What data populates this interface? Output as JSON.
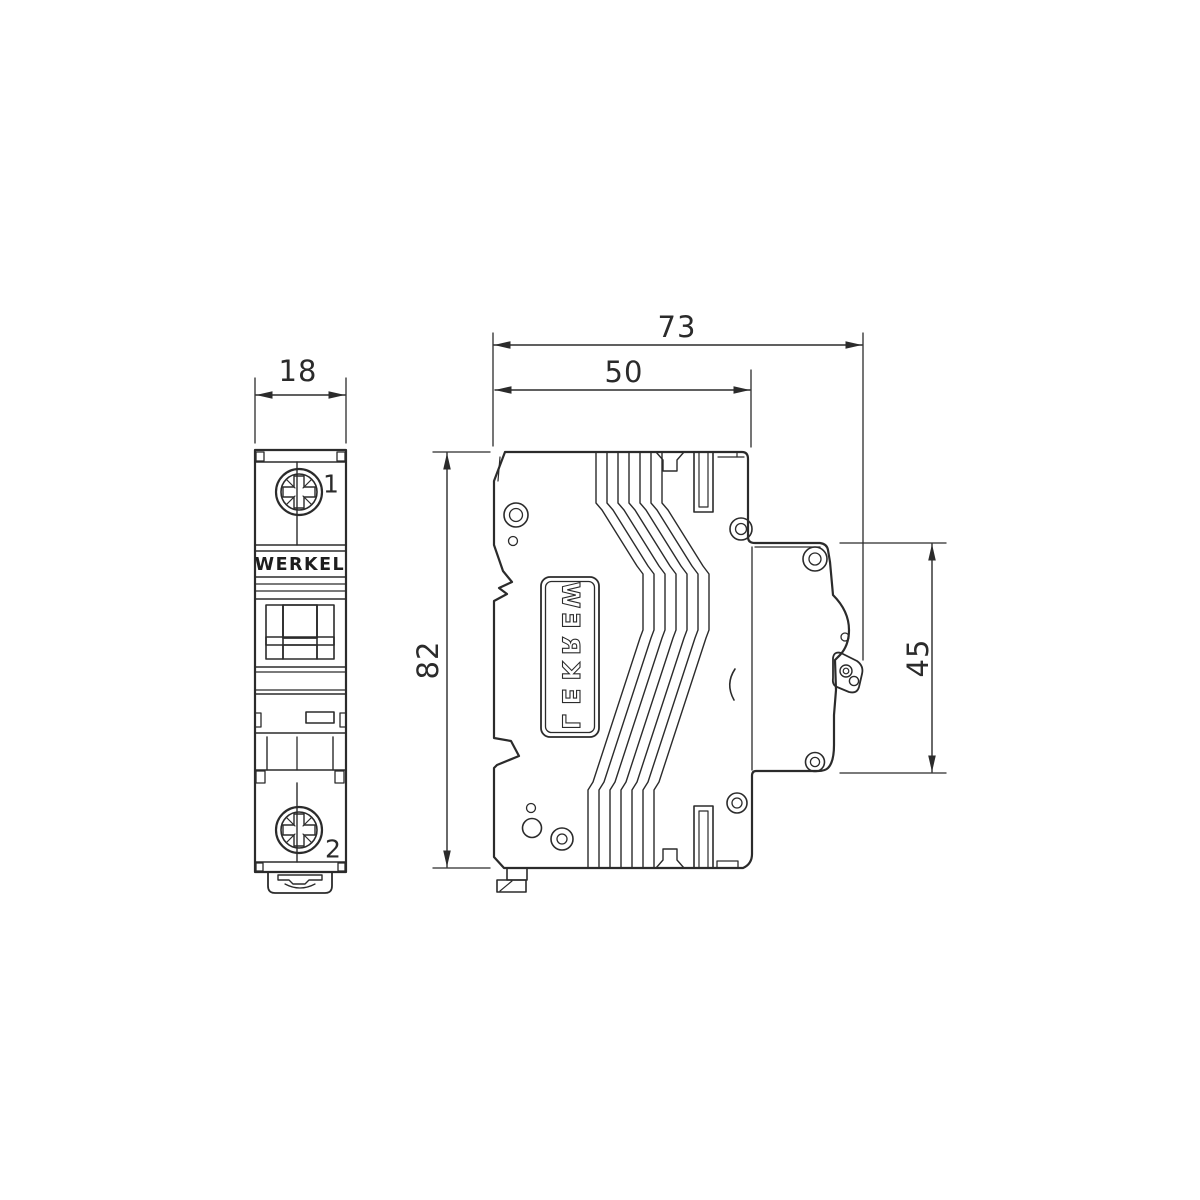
{
  "brand": "WERKEL",
  "front_view": {
    "terminal_top_label": "1",
    "terminal_bottom_label": "2",
    "brand_label": "WERKEL"
  },
  "side_view": {
    "brand_label": "WERKEL",
    "label_letters": [
      "W",
      "E",
      "R",
      "K",
      "E",
      "L"
    ]
  },
  "dimensions": {
    "front_width_mm": "18",
    "total_depth_mm": "73",
    "body_depth_mm": "50",
    "height_mm": "82",
    "din_section_mm": "45"
  },
  "colors": {
    "line": "#2b2b2b",
    "background": "#ffffff",
    "text": "#2b2b2b"
  }
}
